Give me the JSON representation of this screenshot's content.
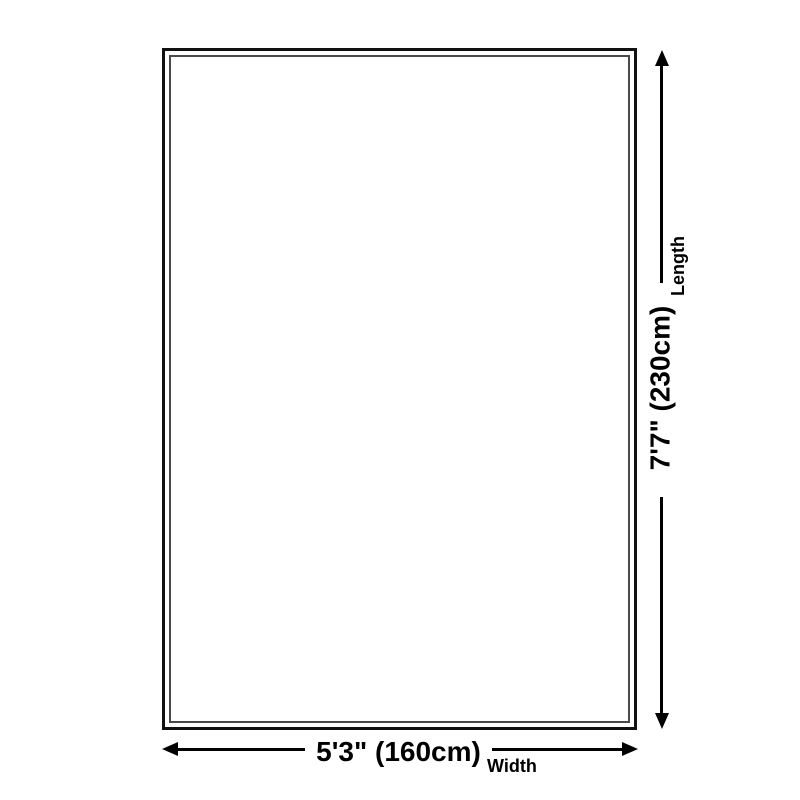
{
  "page": {
    "background": "#ffffff"
  },
  "rug_diagram": {
    "shape": "rectangle-double-border",
    "width_dimension": {
      "value": "5'3\" (160cm)",
      "caption": "Width"
    },
    "length_dimension": {
      "value": "7'7\" (230cm)",
      "caption": "Length"
    },
    "colors": {
      "line": "#000000",
      "text": "#000000",
      "outer_border": "#111111",
      "inner_border": "#4a4a4a",
      "background": "#ffffff"
    }
  }
}
